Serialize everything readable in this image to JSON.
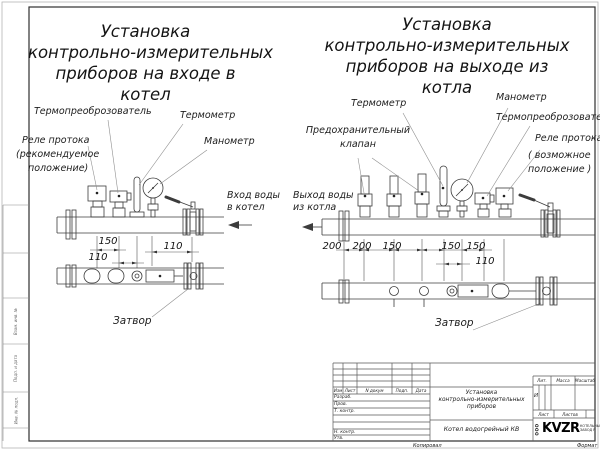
{
  "colors": {
    "line": "#3c3c3c",
    "text": "#1d1d1d",
    "paper": "#ffffff"
  },
  "left_diagram": {
    "title_lines": [
      "Установка",
      "контрольно-измерительных",
      "приборов на входе в",
      "котел"
    ],
    "labels": {
      "transducer": "Термопреоброзователь",
      "thermometer": "Термометр",
      "flow_relay_1": "Реле протока",
      "flow_relay_2": "(рекомендуемое",
      "flow_relay_3": "положение)",
      "manometer": "Манометр",
      "inlet_1": "Вход воды",
      "inlet_2": "в котел",
      "valve": "Затвор"
    },
    "dimensions": [
      "150",
      "110",
      "110"
    ]
  },
  "right_diagram": {
    "title_lines": [
      "Установка",
      "контрольно-измерительных",
      "приборов на выходе из",
      "котла"
    ],
    "labels": {
      "thermometer": "Термометр",
      "manometer": "Манометр",
      "transducer": "Термопреоброзователь",
      "safety_valve_1": "Предохранительный",
      "safety_valve_2": "клапан",
      "flow_relay_1": "Реле протока",
      "flow_relay_2": "( возможное",
      "flow_relay_3": "положение )",
      "outlet_1": "Выход воды",
      "outlet_2": "из котла",
      "valve": "Затвор"
    },
    "dimensions": [
      "200",
      "200",
      "150",
      "150",
      "150",
      "110"
    ]
  },
  "title_block": {
    "col_headers": [
      "Изм",
      "Лист",
      "N докум",
      "Подп.",
      "Дата"
    ],
    "row_labels": [
      "Разраб.",
      "Пров.",
      "Т. контр.",
      "Н. контр.",
      "Утв."
    ],
    "doc_title_lines": [
      "Установка",
      "контрольно-измерительных",
      "приборов"
    ],
    "product": "Котел водогрейный КВ",
    "lit_header": "Лит.",
    "lit_value": "И",
    "mass_header": "Масса",
    "scale_header": "Масштаб",
    "sheet_header": "Лист",
    "sheets_header": "Листов",
    "logo_prefix": "ООО",
    "logo_name": "KVZR",
    "logo_sub_1": "КОТЕЛЬНЫЙ",
    "logo_sub_2": "ЗАВОД Р",
    "copied": "Копировал",
    "format": "Формат"
  },
  "margin_labels": [
    "Взам. инв. №",
    "Подп. и дата",
    "Инв. № подл."
  ]
}
